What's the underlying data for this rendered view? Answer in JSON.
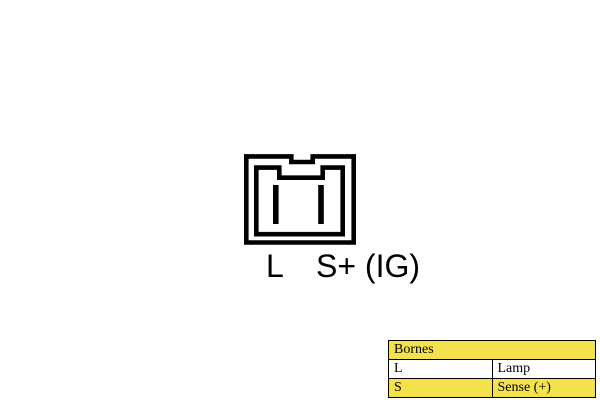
{
  "connector": {
    "pin_labels": [
      {
        "text": "L"
      },
      {
        "text": "S+ (IG)"
      }
    ]
  },
  "table": {
    "header": "Bornes",
    "rows": [
      {
        "terminal": "L",
        "description": "Lamp"
      },
      {
        "terminal": "S",
        "description": "Sense (+)"
      }
    ]
  },
  "colors": {
    "table_header_bg": "#F3E24C",
    "table_alt_row_bg": "#FFFFFF",
    "diagram_line": "#000000",
    "background": "#FFFFFF"
  }
}
